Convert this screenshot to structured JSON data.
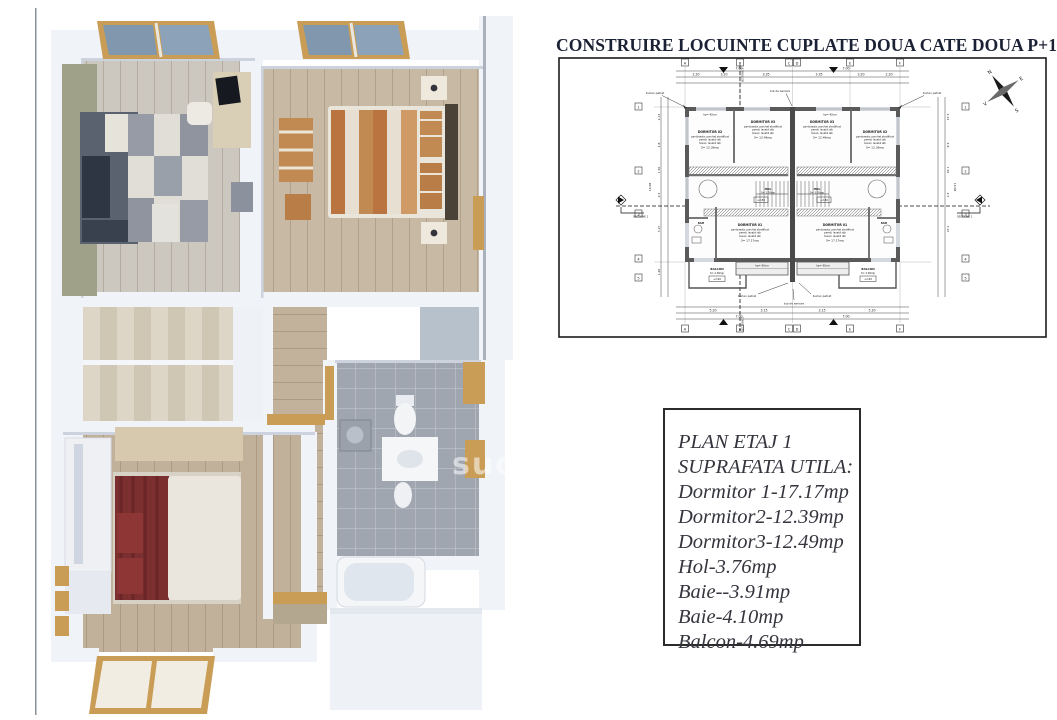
{
  "title": {
    "text": "CONSTRUIRE LOCUINTE CUPLATE DOUA CATE DOUA P+1E+M"
  },
  "info_box": {
    "line1": "PLAN ETAJ 1",
    "line2": "SUPRAFATA UTILA:",
    "line3": "Dormitor 1-17.17mp",
    "line4": "Dormitor2-12.39mp",
    "line5": "Dormitor3-12.49mp",
    "line6": "Hol-3.76mp",
    "line7": "Baie--3.91mp",
    "line8": "Baie-4.10mp",
    "line9": "Balcon-4.69mp"
  },
  "plan": {
    "rooms": {
      "d1": {
        "name": "DORMITOR 01",
        "area": "S= 17.17mp"
      },
      "d2": {
        "name": "DORMITOR 02",
        "area": "S= 12.39mp"
      },
      "d3": {
        "name": "DORMITOR 03",
        "area": "S= 12.49mp"
      },
      "hol": {
        "name": "HOL",
        "area": "S= 3.76mp"
      },
      "baie": {
        "name": "BAIE",
        "area": "S= 3.91mp"
      },
      "balcon": {
        "name": "BALCON",
        "area": "S= 4.69mp"
      }
    },
    "finishes": {
      "floor": "pardoseala: parchet stratificat",
      "walls": "pereti: lavabil alb",
      "ceiling": "tavan: lavabil alb"
    },
    "annotations": {
      "downspout": "burlan patrat",
      "vent": "tub de aerisire",
      "section1": "SECTIUNE 1",
      "section2": "SECTIUNE 2",
      "parapet": "hp= 90cm",
      "elev_balcony": "+2.60",
      "elev_floor": "+2.80"
    },
    "compass": {
      "n": "N",
      "e": "E",
      "s": "S",
      "v": "V"
    },
    "grid": {
      "a": "A",
      "b": "B",
      "c": "C",
      "d": "D",
      "e": "E",
      "f": "F",
      "r1": "1",
      "r2": "2",
      "r3": "3",
      "r4": "4",
      "r5": "5"
    },
    "dims": {
      "top_total_l": "7.00",
      "top_total_r": "7.00",
      "t1": "2.20",
      "t2": "3.20",
      "t3": "3.35",
      "t4": "3.35",
      "t5": "3.20",
      "t6": "2.20",
      "b1": "5.20",
      "b2": "3.15",
      "b3": "3.15",
      "b4": "5.20",
      "bot_total_l": "7.00",
      "bot_total_r": "7.00",
      "side_total": "16.08",
      "l1": "2.13",
      "l2": "4.8",
      "l3": "1.50",
      "l4": "2.5",
      "l5": "3.15",
      "l6": "1.20"
    }
  },
  "render": {
    "watermark": "sud"
  }
}
